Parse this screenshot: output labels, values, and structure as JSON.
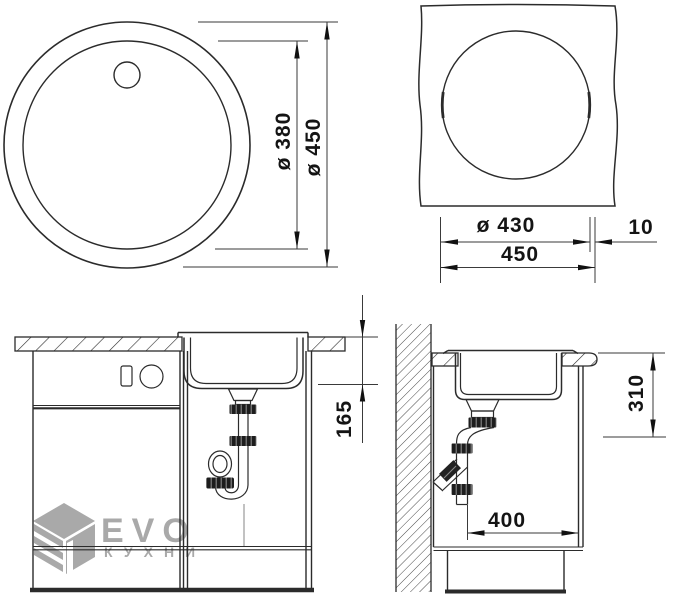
{
  "drawing": {
    "title": "Round kitchen sink installation drawing",
    "views": {
      "top": {
        "dims": {
          "inner_diameter": "ø 380",
          "outer_diameter": "ø 450"
        }
      },
      "cutout": {
        "dims": {
          "cutout_diameter": "ø 430",
          "edge_offset": "10",
          "overall_width": "450"
        }
      },
      "front": {
        "dims": {
          "bowl_depth": "165"
        }
      },
      "side": {
        "dims": {
          "under_counter_depth": "310",
          "cabinet_depth": "400"
        }
      }
    }
  },
  "watermark": {
    "brand": "EVO",
    "subtitle": "КУХНИ"
  },
  "colors": {
    "line": "#2b2b2b",
    "dimension": "#3a3a3a",
    "arrow": "#111111",
    "nut": "#1d1d1d",
    "watermark": "#a9a9a9",
    "background": "#ffffff"
  }
}
